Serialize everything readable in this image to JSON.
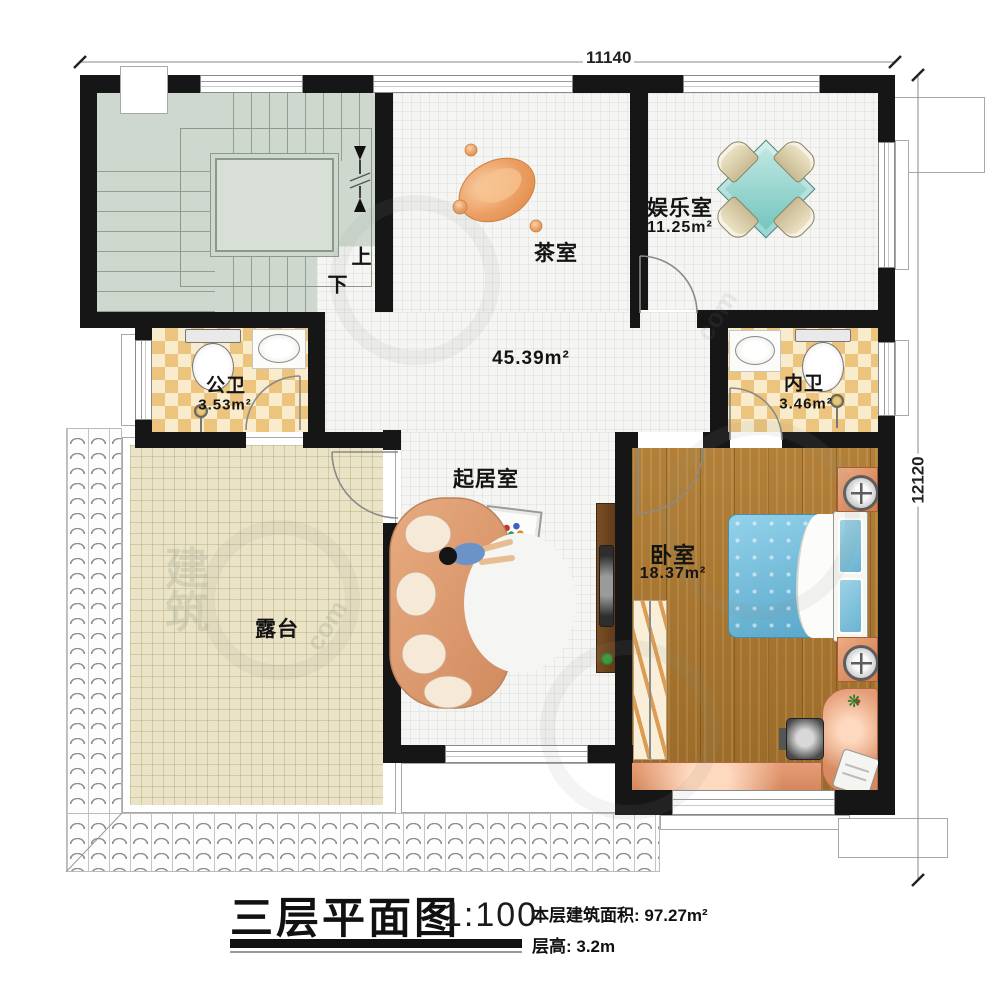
{
  "dimensions": {
    "width_top": "11140",
    "height_right": "12120"
  },
  "rooms": {
    "stairwell": {
      "up": "上",
      "down": "下"
    },
    "tea_room": {
      "name": "茶室"
    },
    "entertainment": {
      "name": "娱乐室",
      "area": "11.25m²"
    },
    "public_bath": {
      "name": "公卫",
      "area": "3.53m²"
    },
    "inner_bath": {
      "name": "内卫",
      "area": "3.46m²"
    },
    "hall": {
      "area": "45.39m²"
    },
    "living_room": {
      "name": "起居室"
    },
    "bedroom": {
      "name": "卧室",
      "area": "18.37m²"
    },
    "terrace": {
      "name": "露台"
    }
  },
  "title_block": {
    "title": "三层平面图",
    "scale": "1:100",
    "area_line": "本层建筑面积: 97.27m²",
    "height_line": "层高: 3.2m"
  },
  "watermark": {
    "text_a": "建筑",
    "text_b": "com"
  },
  "colors": {
    "wall": "#161616",
    "stair_floor": "#ced8ce",
    "tile_floor": "#f5f5f3",
    "checker_tan": "#ecc47e",
    "checker_cream": "#f9eccd",
    "wood_floor": "#a9772f",
    "terrace_floor": "#ebe3c6",
    "bed_blue": "#6fb7d7",
    "sofa_salmon": "#dfa077",
    "desk_salmon": "#e59d77",
    "table_teal": "#8fd3cc"
  }
}
